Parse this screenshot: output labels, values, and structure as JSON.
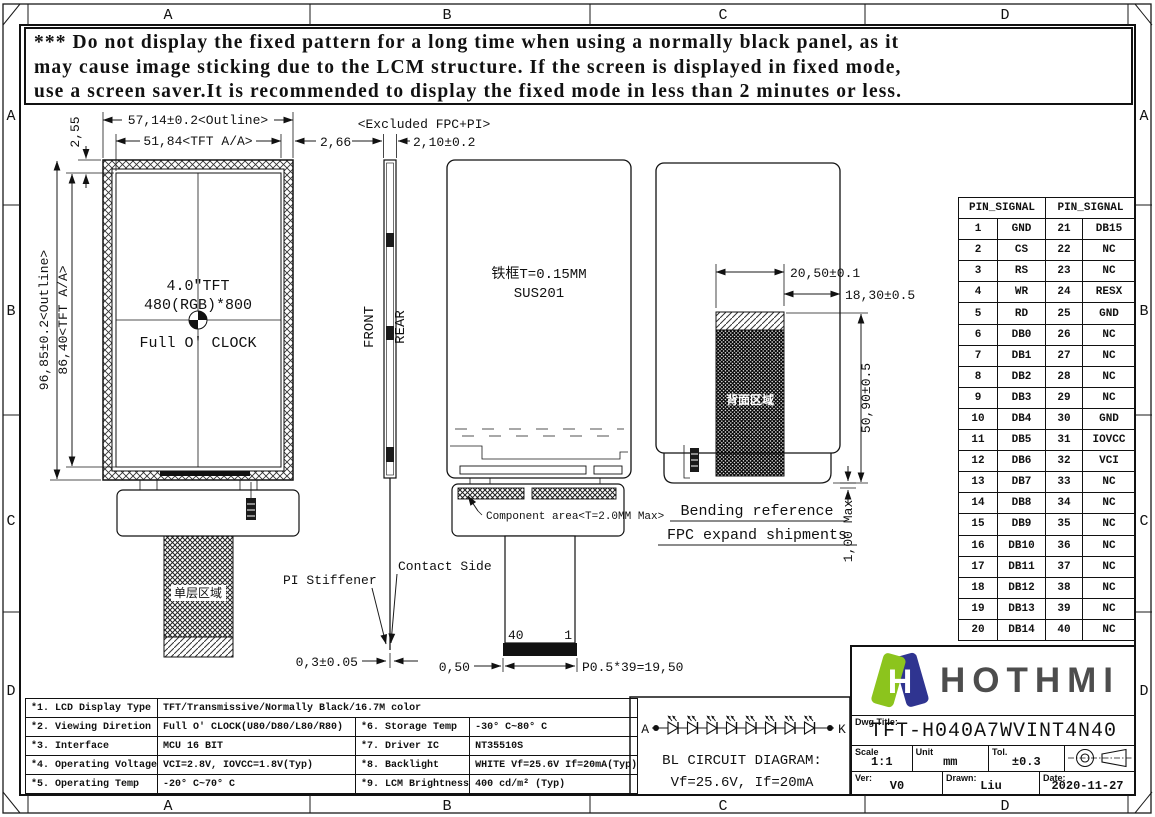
{
  "warning": {
    "line1": "*** Do not display the fixed pattern for a long time when using a normally black panel, as it",
    "line2": "may cause image sticking due to the LCM structure. If the screen is displayed in fixed mode,",
    "line3": "use a screen saver.It is recommended to display the fixed mode in less than 2 minutes or less."
  },
  "grid": {
    "letters": [
      "A",
      "B",
      "C",
      "D"
    ]
  },
  "front_view": {
    "dim_outline_w": "57,14±0.2<Outline>",
    "dim_aa_w": "51,84<TFT A/A>",
    "dim_border_r": "2,66",
    "dim_border_t": "2,55",
    "dim_outline_h": "96,85±0.2<Outline>",
    "dim_aa_h": "86,40<TFT A/A>",
    "label_size": "4.0″TFT",
    "label_res": "480(RGB)*800",
    "label_clock": "Full O' CLOCK",
    "fpc_area_label": "单层区域"
  },
  "side_view": {
    "top_note": "<Excluded FPC+PI>",
    "dim_thickness": "2,10±0.2",
    "front_label": "FRONT",
    "rear_label": "REAR",
    "pi_stiffener": "PI Stiffener",
    "contact_side": "Contact Side",
    "dim_pi": "0,3±0.05"
  },
  "rear_view": {
    "frame_note1": "铁框T=0.15MM",
    "frame_note2": "SUS201",
    "component_area": "Component area<T=2.0MM Max>",
    "pin40": "40",
    "pin1": "1",
    "dim_offset": "0,50",
    "dim_pitch": "P0.5*39=19,50"
  },
  "bend_view": {
    "dim_w1": "20,50±0.1",
    "dim_w2": "18,30±0.5",
    "dim_h": "50,90±0.5",
    "dim_max": "1,00 Max",
    "area_label": "背面区域",
    "caption1": "Bending reference",
    "caption2": "FPC expand shipments"
  },
  "bl_circuit": {
    "anode": "A",
    "cathode": "K",
    "title": "BL CIRCUIT DIAGRAM:",
    "subtitle": "Vf=25.6V, If=20mA"
  },
  "pin_table": {
    "header": "PIN_SIGNAL",
    "rows": [
      {
        "p1": "1",
        "s1": "GND",
        "p2": "21",
        "s2": "DB15"
      },
      {
        "p1": "2",
        "s1": "CS",
        "p2": "22",
        "s2": "NC"
      },
      {
        "p1": "3",
        "s1": "RS",
        "p2": "23",
        "s2": "NC"
      },
      {
        "p1": "4",
        "s1": "WR",
        "p2": "24",
        "s2": "RESX"
      },
      {
        "p1": "5",
        "s1": "RD",
        "p2": "25",
        "s2": "GND"
      },
      {
        "p1": "6",
        "s1": "DB0",
        "p2": "26",
        "s2": "NC"
      },
      {
        "p1": "7",
        "s1": "DB1",
        "p2": "27",
        "s2": "NC"
      },
      {
        "p1": "8",
        "s1": "DB2",
        "p2": "28",
        "s2": "NC"
      },
      {
        "p1": "9",
        "s1": "DB3",
        "p2": "29",
        "s2": "NC"
      },
      {
        "p1": "10",
        "s1": "DB4",
        "p2": "30",
        "s2": "GND"
      },
      {
        "p1": "11",
        "s1": "DB5",
        "p2": "31",
        "s2": "IOVCC"
      },
      {
        "p1": "12",
        "s1": "DB6",
        "p2": "32",
        "s2": "VCI"
      },
      {
        "p1": "13",
        "s1": "DB7",
        "p2": "33",
        "s2": "NC"
      },
      {
        "p1": "14",
        "s1": "DB8",
        "p2": "34",
        "s2": "NC"
      },
      {
        "p1": "15",
        "s1": "DB9",
        "p2": "35",
        "s2": "NC"
      },
      {
        "p1": "16",
        "s1": "DB10",
        "p2": "36",
        "s2": "NC"
      },
      {
        "p1": "17",
        "s1": "DB11",
        "p2": "37",
        "s2": "NC"
      },
      {
        "p1": "18",
        "s1": "DB12",
        "p2": "38",
        "s2": "NC"
      },
      {
        "p1": "19",
        "s1": "DB13",
        "p2": "39",
        "s2": "NC"
      },
      {
        "p1": "20",
        "s1": "DB14",
        "p2": "40",
        "s2": "NC"
      }
    ]
  },
  "spec_table": {
    "rows": [
      {
        "k": "*1. LCD Display Type",
        "v": "TFT/Transmissive/Normally Black/16.7M color",
        "k2": "",
        "v2": ""
      },
      {
        "k": "*2. Viewing Diretion",
        "v": "Full O' CLOCK(U80/D80/L80/R80)",
        "k2": "*6. Storage Temp",
        "v2": "-30° C~80° C"
      },
      {
        "k": "*3. Interface",
        "v": "MCU 16 BIT",
        "k2": "*7. Driver IC",
        "v2": "NT35510S"
      },
      {
        "k": "*4. Operating Voltage",
        "v": "VCI=2.8V, IOVCC=1.8V(Typ)",
        "k2": "*8. Backlight",
        "v2": "WHITE Vf=25.6V If=20mA(Typ)"
      },
      {
        "k": "*5. Operating Temp",
        "v": "-20° C~70° C",
        "k2": "*9. LCM Brightness",
        "v2": "400 cd/m² (Typ)"
      }
    ]
  },
  "title_block": {
    "brand": "HOTHMI",
    "dwg_title_label": "Dwg Title:",
    "title": "TFT-H040A7WVINT4N40",
    "scale_label": "Scale",
    "scale": "1:1",
    "unit_label": "Unit",
    "unit": "mm",
    "tol_label": "Tol.",
    "tol": "±0.3",
    "ver_label": "Ver:",
    "ver": "V0",
    "drawn_label": "Drawn:",
    "drawn": "Liu",
    "date_label": "Date:",
    "date": "2020-11-27"
  },
  "colors": {
    "logo_green": "#8CC41D",
    "logo_navy": "#2F3490",
    "brand_text": "#4D4D4D"
  }
}
